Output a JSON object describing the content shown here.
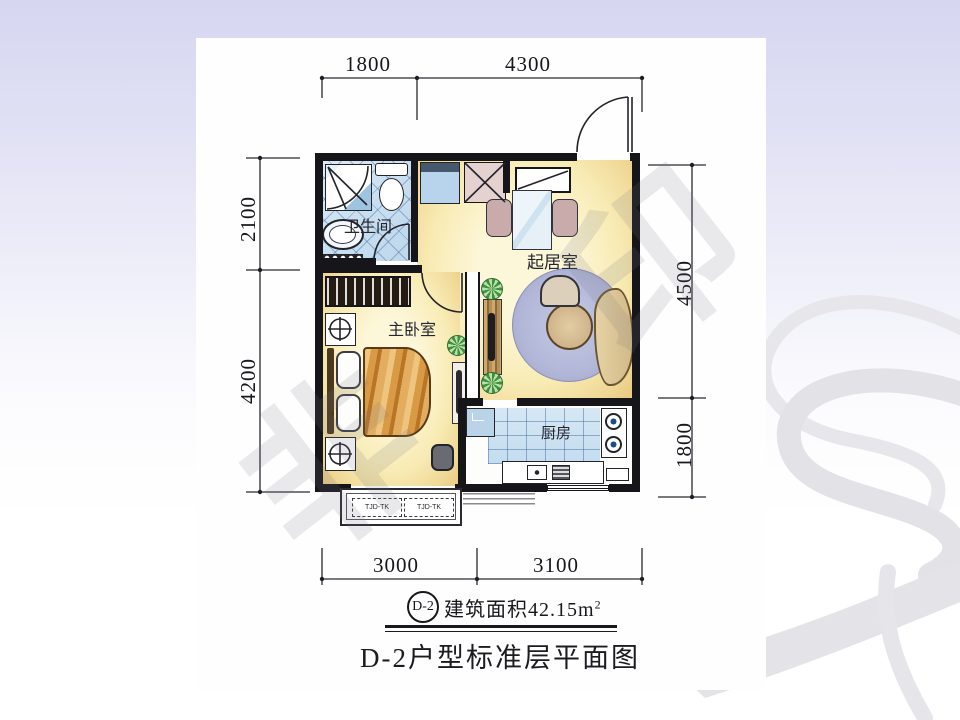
{
  "slide": {
    "background_top_color": "#d6d6f1",
    "swoosh_color": "#e4e4e9"
  },
  "plan": {
    "rooms": {
      "bathroom": "卫生间",
      "bedroom": "主卧室",
      "living": "起居室",
      "kitchen": "厨房"
    },
    "dims": {
      "top1": "1800",
      "top2": "4300",
      "left1": "2100",
      "left2": "4200",
      "right1": "4500",
      "right2": "1800",
      "bottom1": "3000",
      "bottom2": "3100"
    },
    "ac1": "TJD-TK",
    "ac2": "TJD-TK",
    "watermark1": "非",
    "watermark2": "印",
    "colors": {
      "tile_blue": "#c9dff0",
      "floor_yellow": "#f8ebb4",
      "duvet_orange": "#d4903c",
      "rug_lavender": "#b7bcdc"
    }
  },
  "footer": {
    "unit": "D-2",
    "area_label": "建筑面积42.15m",
    "area_sup": "2",
    "caption": "D-2户型标准层平面图"
  }
}
